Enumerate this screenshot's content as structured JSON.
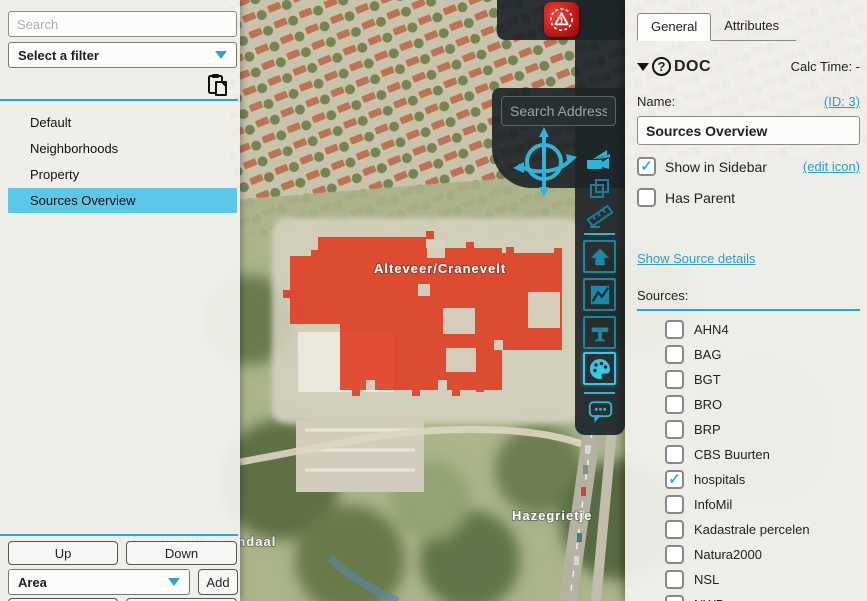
{
  "accent": {
    "teal": "#29a7c9",
    "teal_bright": "#2fb3d6",
    "selection_blue": "#5bc8e8",
    "overlay_red": "#e03418"
  },
  "left_sidebar": {
    "search_placeholder": "Search",
    "filter_value": "Select a filter",
    "items": [
      {
        "label": "Default",
        "selected": false
      },
      {
        "label": "Neighborhoods",
        "selected": false
      },
      {
        "label": "Property",
        "selected": false
      },
      {
        "label": "Sources Overview",
        "selected": true
      }
    ],
    "buttons": {
      "up": "Up",
      "down": "Down",
      "add": "Add"
    },
    "area_value": "Area"
  },
  "map": {
    "search_placeholder": "Search Address",
    "area_label": "Alteveer/Cranevelt",
    "place_label": "Hazegrietje",
    "park_label": "Sonsbeek/Zijpendaal"
  },
  "right_panel": {
    "tabs": [
      {
        "label": "General",
        "active": true
      },
      {
        "label": "Attributes",
        "active": false
      }
    ],
    "section_title": "DOC",
    "calc_time": "Calc Time: -",
    "name_label": "Name:",
    "id_link": "(ID: 3)",
    "name_value": "Sources Overview",
    "show_in_sidebar": {
      "label": "Show in Sidebar",
      "checked": true
    },
    "edit_icon_link": "(edit icon)",
    "has_parent": {
      "label": "Has Parent",
      "checked": false
    },
    "show_source_details": "Show Source details",
    "sources_label": "Sources:",
    "sources": [
      {
        "label": "AHN4",
        "checked": false
      },
      {
        "label": "BAG",
        "checked": false
      },
      {
        "label": "BGT",
        "checked": false
      },
      {
        "label": "BRO",
        "checked": false
      },
      {
        "label": "BRP",
        "checked": false
      },
      {
        "label": "CBS Buurten",
        "checked": false
      },
      {
        "label": "hospitals",
        "checked": true
      },
      {
        "label": "InfoMil",
        "checked": false
      },
      {
        "label": "Kadastrale percelen",
        "checked": false
      },
      {
        "label": "Natura2000",
        "checked": false
      },
      {
        "label": "NSL",
        "checked": false
      },
      {
        "label": "NWB",
        "checked": false
      }
    ]
  }
}
